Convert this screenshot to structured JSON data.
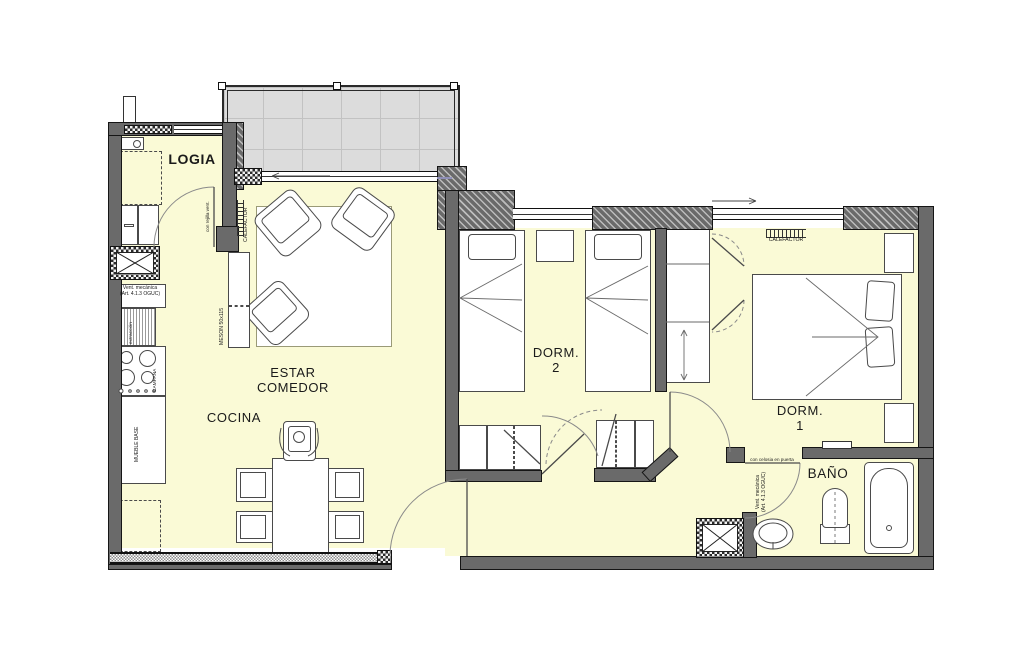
{
  "drawing": {
    "kind": "apartment floor plan",
    "units_visible_text_language": "es"
  },
  "colors": {
    "room_fill": "#FAFAD6",
    "terrace_fill": "#DCDCDC",
    "wall_fill": "#6A6A6A",
    "wall_edge": "#151515",
    "glass_line": "#8F8FB8",
    "furniture_line": "#4A4A4A"
  },
  "rooms": {
    "logia": {
      "name": "LOGIA"
    },
    "cocina": {
      "name": "COCINA"
    },
    "estar_comedor": {
      "line1": "ESTAR",
      "line2": "COMEDOR"
    },
    "dorm2": {
      "line1": "DORM.",
      "line2": "2"
    },
    "dorm1": {
      "line1": "DORM.",
      "line2": "1"
    },
    "bano": {
      "name": "BAÑO"
    }
  },
  "annotations": {
    "calefactor_estar": "CALEFACTOR",
    "calefactor_dorm1": "CALEFACTOR",
    "rejilla_vent": "con rejilla vent.",
    "meson": "MESON 50x115",
    "vent_mecanica_cocina_l1": "Vent. mecánica",
    "vent_mecanica_cocina_l2": "(Art. 4.1.3 OGUC)",
    "vent_mecanica_bano_l1": "Vent. mecánica",
    "vent_mecanica_bano_l2": "(Art. 4.1.3 OGUC)",
    "campana": "CAMPANA",
    "extraccion": "extracción",
    "mueble_base": "MUEBLE BASE",
    "celosia_puerta": "con celosia en puerta"
  }
}
